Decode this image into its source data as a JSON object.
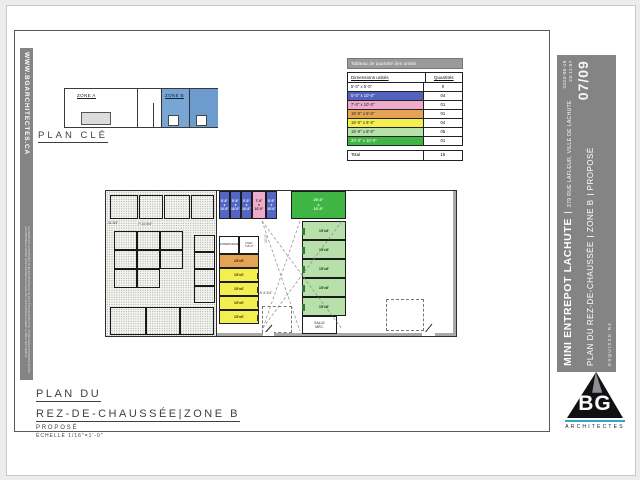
{
  "left_strip": {
    "website": "WWW.BGARCHITECTES.CA",
    "fine_print": "CE DESSIN EST LA PROPRIÉTÉ DE BG ARCHITECTES ET NE PEUT ÊTRE REPRODUIT OU UTILISÉ SANS AUTORISATION ÉCRITE. LES DIMENSIONS DOIVENT ÊTRE VÉRIFIÉES SUR PLACE PAR L'ENTREPRENEUR AVANT LE DÉBUT DES TRAVAUX."
  },
  "key_plan": {
    "title": "PLAN CLÉ",
    "zone_a": "ZONE A",
    "zone_b": "ZONE B"
  },
  "table": {
    "title": "Tableau de quantité des unités",
    "col_dim": "Dimensions unités",
    "col_qty": "Quantités",
    "rows": [
      {
        "dim": "5'-0\" x 5'-0\"",
        "qty": "0",
        "css": "background:#ffffff;color:#111111;"
      },
      {
        "dim": "5'-0\" x 10'-0\"",
        "qty": "04",
        "css": "background:#5163be;color:#ffffff;"
      },
      {
        "dim": "7'-0\" x 10'-0\"",
        "qty": "01",
        "css": "background:#f0aacb;color:#222222;"
      },
      {
        "dim": "15'-0\" x 5'-0\"",
        "qty": "01",
        "css": "background:#e5a455;color:#222222;"
      },
      {
        "dim": "15'-0\" x 6'-0\"",
        "qty": "04",
        "css": "background:#f4ee4e;color:#222222;"
      },
      {
        "dim": "15'-0\" x 8'-0\"",
        "qty": "05",
        "css": "background:#b7e0aa;color:#222222;"
      },
      {
        "dim": "20'-0\" x 10'-0\"",
        "qty": "01",
        "css": "background:#3fb544;color:#ffffff;"
      }
    ],
    "total_label": "Total",
    "total_value": "16"
  },
  "plan": {
    "top_units": [
      {
        "label": "5'-0\"\nx\n10'-0\"",
        "css": "background:#5366c4;color:#ffffff;"
      },
      {
        "label": "5'-0\"\nx\n10'-0\"",
        "css": "background:#5366c4;color:#ffffff;"
      },
      {
        "label": "5'-0\"\nx\n10'-0\"",
        "css": "background:#5366c4;color:#ffffff;"
      },
      {
        "label": "7'-0\"\nx\n10'-0\"",
        "css": "background:#f0aacb;color:#222222;"
      },
      {
        "label": "5'-0\"\nx\n10'-0\"",
        "css": "background:#5366c4;color:#ffffff;"
      }
    ],
    "big_unit": {
      "label": "20'-0\"\nx\n10'-0\"",
      "css": "background:#3fb544;color:#ffffff;"
    },
    "side_unit_label": "15'x8'",
    "mid_unit_label": "15'x6'",
    "orange_unit": {
      "label": "15'x5'",
      "css": "background:#e5a455;color:#3a2a10;"
    },
    "room_entreposage": "ENTREPOSAGE",
    "room_cvac": "CVAC\n7'x5'-0\"",
    "room_mech": "SALLE\nMÉC.",
    "dims": {
      "d1": "11 3/4\"",
      "d2": "7'-11 3/4\"",
      "d3": "19'-5 3/4\"",
      "d4": "10'-0\""
    }
  },
  "title_block": {
    "l1": "PLAN DU",
    "l2": "REZ-DE-CHAUSSÉE|ZONE B",
    "status": "PROPOSÉ",
    "scale": "ÉCHELLE 1/16\"=1'-0\""
  },
  "sidebar": {
    "project": "MINI ENTREPOT LACHUTE",
    "address": "379 RUE LAFLEUR, VILLE DE LACHUTE",
    "sheet_title": "PLAN DU REZ-DE-CHAUSSÉE",
    "zone": "ZONE B",
    "status": "PROPOSÉ",
    "revision": "ESQUISSE R4",
    "date": "2023-06-19",
    "time": "23:11:57",
    "page": "07/09"
  },
  "logo": {
    "initials": "BG",
    "name": "ARCHITECTES"
  }
}
